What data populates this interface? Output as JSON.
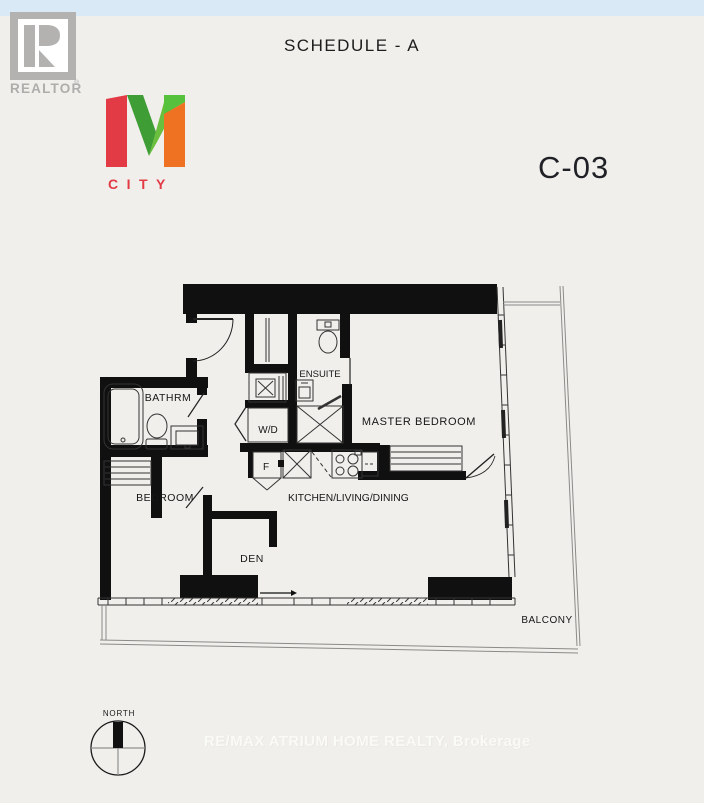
{
  "page": {
    "background": "#f1efec",
    "top_strip_color": "#d9e9f6"
  },
  "header": {
    "title": "SCHEDULE - A",
    "unit_code": "C-03"
  },
  "realtor_logo": {
    "label": "REALTOR",
    "registered": "®",
    "color": "#b3b2b0"
  },
  "mcity_logo": {
    "city_label": "CITY",
    "colors": {
      "red": "#e23b46",
      "dark_green": "#3f9d36",
      "light_green": "#6abf3f",
      "bright_green": "#55c13c",
      "orange": "#ef7122"
    }
  },
  "floor_plan": {
    "rooms": {
      "bathroom": "BATHRM",
      "bedroom": "BEDROOM",
      "den": "DEN",
      "kitchen_living_dining": "KITCHEN/LIVING/DINING",
      "master_bedroom": "MASTER BEDROOM",
      "ensuite": "ENSUITE",
      "washer_dryer": "W/D",
      "fridge": "F",
      "balcony": "BALCONY"
    }
  },
  "compass": {
    "label": "NORTH"
  },
  "watermark": {
    "text": "RE/MAX ATRIUM HOME REALTY, Brokerage"
  }
}
